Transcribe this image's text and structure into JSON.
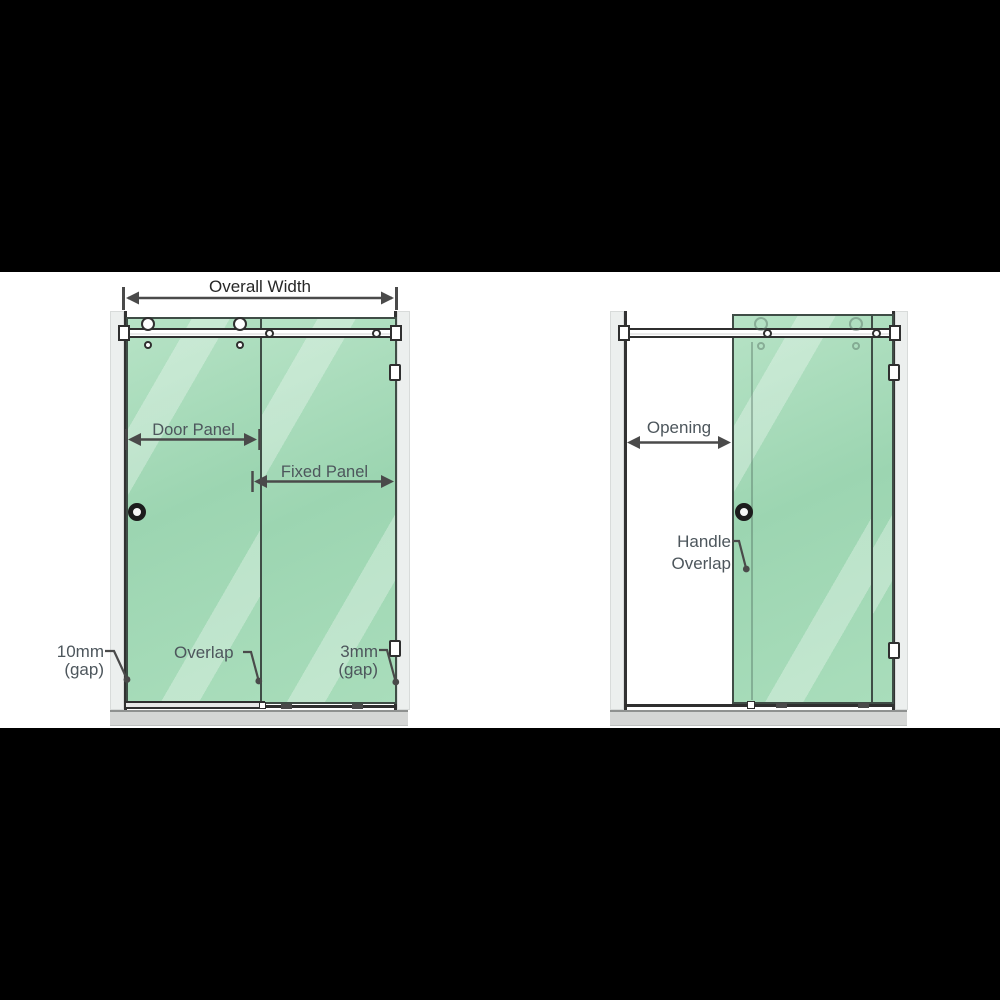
{
  "figure": {
    "title": "Sliding shower screen dimension diagram",
    "colors": {
      "letterbox": "#000000",
      "glass_green": "#9cd5b1",
      "glass_edge": "#3f4d46",
      "dimension_line": "#4a4a4a",
      "label_gray": "#4d565c",
      "floor_gray": "#d5d6d5",
      "wall_gray": "#ecefee"
    }
  },
  "left_diagram": {
    "name": "closed-configuration",
    "labels": {
      "overall_width": "Overall Width",
      "door_panel": "Door Panel",
      "fixed_panel": "Fixed Panel",
      "gap_left_value": "10mm",
      "gap_left_unit": "(gap)",
      "overlap": "Overlap",
      "gap_right_value": "3mm",
      "gap_right_unit": "(gap)"
    }
  },
  "right_diagram": {
    "name": "open-configuration",
    "labels": {
      "opening": "Opening",
      "handle_overlap_line1": "Handle",
      "handle_overlap_line2": "Overlap"
    }
  }
}
